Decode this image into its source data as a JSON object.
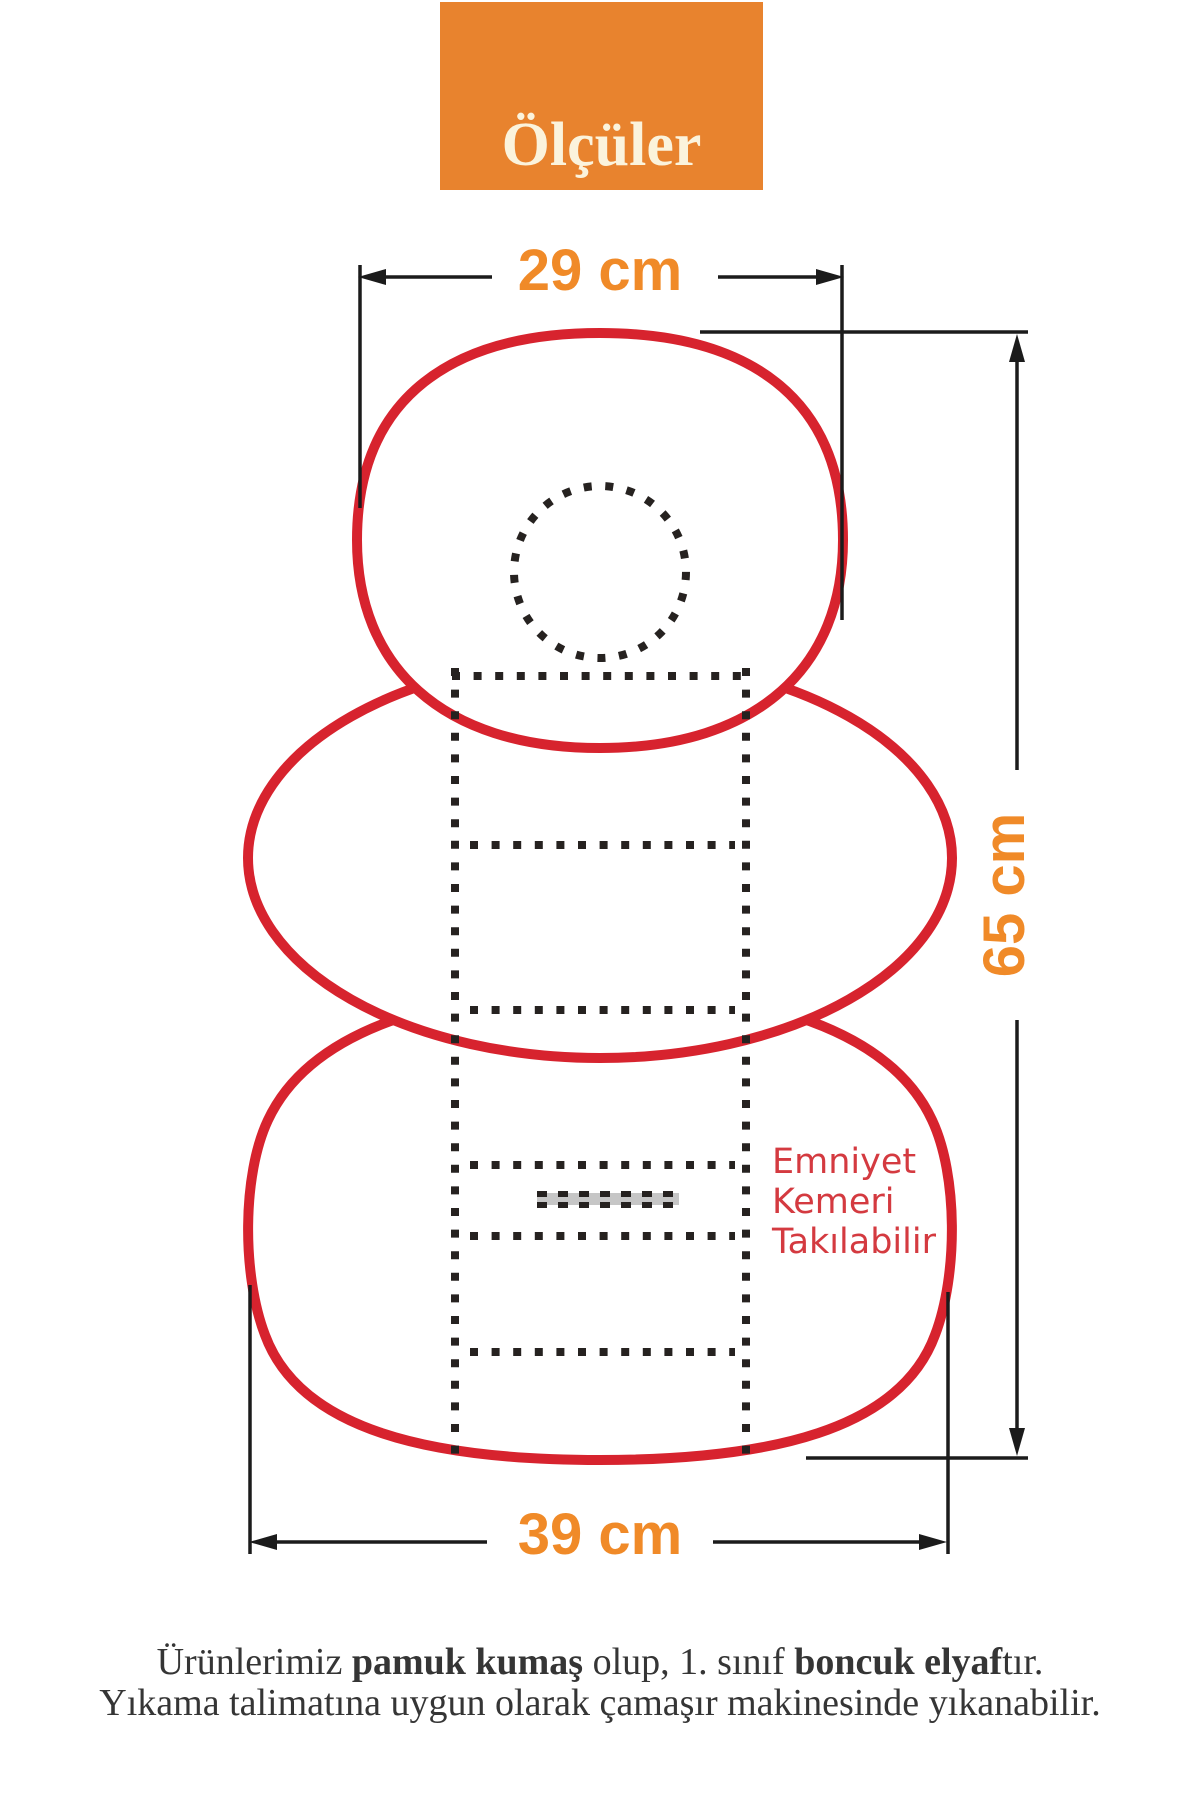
{
  "title": {
    "label": "Ölçüler"
  },
  "dimensions": {
    "top_width": "29 cm",
    "height": "65 cm",
    "bottom_width": "39 cm"
  },
  "note": {
    "lines": [
      "Emniyet",
      "Kemeri",
      "Takılabilir"
    ]
  },
  "footer": {
    "line1_segments": [
      {
        "text": "Ürünlerimiz ",
        "bold": false
      },
      {
        "text": "pamuk kumaş",
        "bold": true
      },
      {
        "text": " olup, 1. sınıf ",
        "bold": false
      },
      {
        "text": "boncuk elyaf",
        "bold": true
      },
      {
        "text": "tır.",
        "bold": false
      }
    ],
    "line2": "Yıkama talimatına uygun olarak çamaşır makinesinde yıkanabilir."
  },
  "colors": {
    "accent_orange": "#E8832E",
    "dimension_orange": "#F08A28",
    "outline_red": "#D7232E",
    "note_red": "#D43A40",
    "line_black": "#1B1B1B",
    "dot_black": "#262220",
    "slot_gray": "#C6C6C6",
    "title_cream": "#FBF3DC",
    "text_dark": "#353535"
  }
}
